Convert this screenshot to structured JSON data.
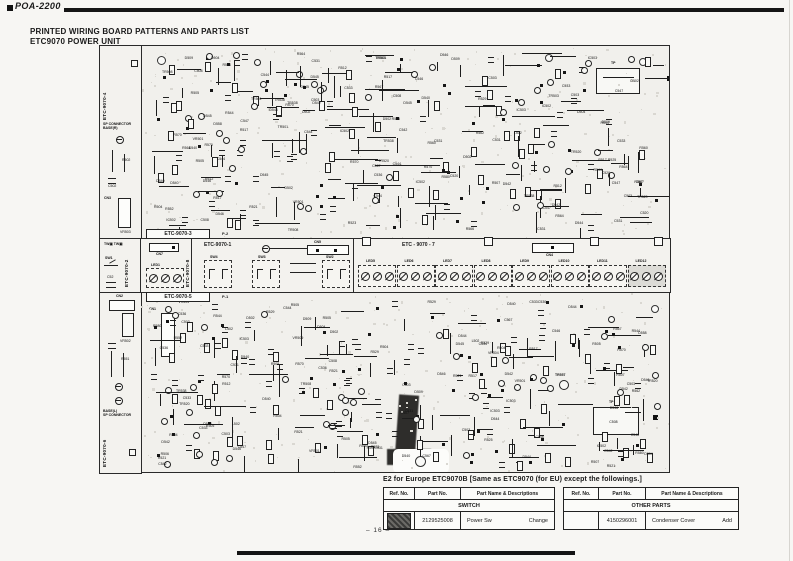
{
  "page": {
    "model": "POA-2200",
    "title_line1": "PRINTED WIRING BOARD PATTERNS AND PARTS LIST",
    "title_line2": "ETC9070 POWER UNIT",
    "page_number": "– 16 –"
  },
  "board": {
    "sections": {
      "top_pattern": "ETC-9070-3",
      "bottom_pattern": "ETC-9070-5",
      "left_top": "ETC-9070-4",
      "left_bottom": "ETC-9070-6",
      "strip_switch": "ETC-9070-2",
      "strip_led": "ETC-9070-8",
      "strip_mid": "ETC-9070-1",
      "strip_right": "ETC - 9070 - 7"
    },
    "labels": {
      "sp_connector_r_1": "SP CONNECTOR",
      "sp_connector_r_2": "BASE(R)",
      "sp_connector_l_1": "BASE(L)",
      "sp_connector_l_2": "SP CONNECTOR",
      "tw": "TW",
      "sw1": "SW1",
      "c52": "C52",
      "cn7": "CN7",
      "led1": "LED1",
      "cn5": "CN5",
      "sw4": "SW4",
      "sw3": "SW3",
      "sw2": "SW2",
      "cn4": "CN4",
      "cn2": "CN2",
      "cn1": "CN1",
      "cn3": "CN3",
      "tp": "TP",
      "p1": "P-1",
      "p2": "P-2",
      "tr557": "TR557",
      "vr502": "VR502",
      "vr503": "VR503"
    },
    "led_groups": [
      "LED5",
      "LED6",
      "LED7",
      "LED8",
      "LED9",
      "LED10",
      "LED11",
      "LED12"
    ],
    "component_labels": [
      "R552",
      "L502",
      "D502",
      "R560",
      "D542",
      "C542",
      "R570",
      "IC502",
      "R562",
      "VR504",
      "C544",
      "C546",
      "R564",
      "R566",
      "R504",
      "TR520",
      "C536",
      "D540",
      "R544",
      "TR508",
      "D504",
      "R529",
      "C530",
      "D558",
      "R525",
      "R523",
      "C533",
      "R517",
      "D509",
      "R507",
      "TR503",
      "C503",
      "R505",
      "VR501",
      "C508",
      "R567",
      "C567",
      "IC503",
      "TR501",
      "C520",
      "R512",
      "D544",
      "D546",
      "TR538",
      "R580",
      "C531",
      "R521",
      "D545",
      "C547",
      "R506"
    ]
  },
  "europe_note": {
    "heading": "E2 for Europe ETC9070B  [Same as ETC9070 (for EU) except the followings.]",
    "tables": [
      {
        "columns": [
          "Ref. No.",
          "Part No.",
          "Part Name & Descriptions"
        ],
        "section": "SWITCH",
        "row": {
          "ref": "",
          "part_no": "2129525008",
          "name": "Power Sw",
          "note": "Change"
        }
      },
      {
        "columns": [
          "Ref. No.",
          "Part No.",
          "Part Name & Descriptions"
        ],
        "section": "OTHER PARTS",
        "row": {
          "ref": "",
          "part_no": "4150296001",
          "name": "Condenser Cover",
          "note": "Add"
        }
      }
    ]
  }
}
